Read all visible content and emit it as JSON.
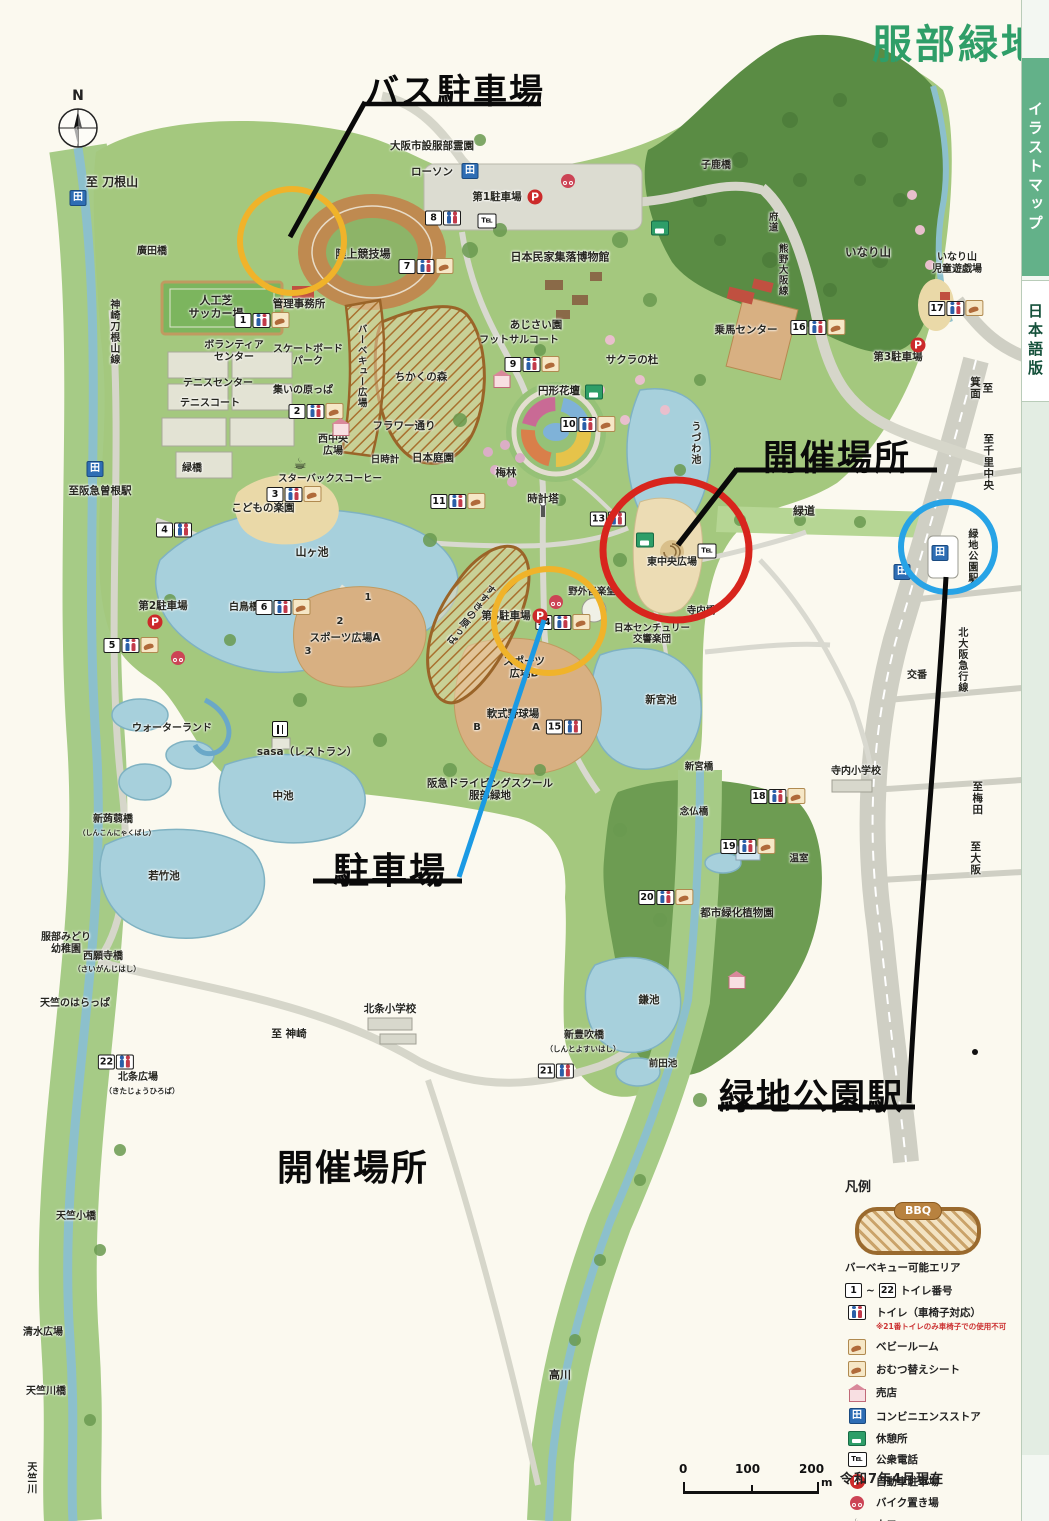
{
  "title": "服部緑地",
  "sidebar": {
    "top": "イラストマップ",
    "bottom": "日本語版"
  },
  "annotations": {
    "bus_parking": "バス駐車場",
    "event_location": "開催場所",
    "parking": "駐車場",
    "station": "緑地公園駅",
    "event_location_bottom": "開催場所"
  },
  "glyphs": {
    "north": "N",
    "parking": "P",
    "conbini": "田",
    "tel": "℡",
    "cafe": "☕"
  },
  "legend": {
    "heading": "凡例",
    "bbq_badge": "BBQ",
    "bbq_label": "バーベキュー可能エリア",
    "toilet_range": {
      "from": "1",
      "sep": "~",
      "to": "22",
      "label": "トイレ番号"
    },
    "items": [
      {
        "icon": "wc",
        "label": "トイレ（車椅子対応）",
        "note": "※21番トイレのみ車椅子での使用不可"
      },
      {
        "icon": "diaper",
        "label": "ベビールーム"
      },
      {
        "icon": "diaper",
        "label": "おむつ替えシート"
      },
      {
        "icon": "shop",
        "label": "売店"
      },
      {
        "icon": "conbini",
        "label": "コンビニエンスストア"
      },
      {
        "icon": "rest",
        "label": "休憩所"
      },
      {
        "icon": "tel",
        "label": "公衆電話"
      },
      {
        "icon": "parking",
        "label": "自動車駐車場"
      },
      {
        "icon": "bike",
        "label": "バイク置き場"
      },
      {
        "icon": "cafe",
        "label": "カフェ"
      },
      {
        "icon": "restaurant",
        "label": "レストラン"
      }
    ]
  },
  "date_note": "令和7年4月現在",
  "scale": {
    "t0": "0",
    "t1": "100",
    "t2": "200",
    "unit": "m"
  },
  "map_labels": [
    {
      "t": "至 刀根山",
      "x": 112,
      "y": 182,
      "s": 12
    },
    {
      "t": "廣田橋",
      "x": 152,
      "y": 252,
      "s": 10
    },
    {
      "t": "神崎刀根山線",
      "x": 113,
      "y": 332,
      "s": 10,
      "v": 1
    },
    {
      "t": "人工芝\nサッカー場",
      "x": 216,
      "y": 308,
      "s": 11
    },
    {
      "t": "管理事務所",
      "x": 299,
      "y": 304,
      "s": 10.5
    },
    {
      "t": "陸上競技場",
      "x": 363,
      "y": 255,
      "s": 11
    },
    {
      "t": "ボランティア\nセンター",
      "x": 234,
      "y": 352,
      "s": 10
    },
    {
      "t": "スケートボード\nパーク",
      "x": 308,
      "y": 356,
      "s": 10
    },
    {
      "t": "テニスセンター",
      "x": 218,
      "y": 384,
      "s": 10
    },
    {
      "t": "テニスコート",
      "x": 210,
      "y": 404,
      "s": 10
    },
    {
      "t": "集いの原っぱ",
      "x": 303,
      "y": 391,
      "s": 10
    },
    {
      "t": "バーベキュー広場",
      "x": 361,
      "y": 366,
      "s": 9.5,
      "v": 1
    },
    {
      "t": "ちかくの森",
      "x": 421,
      "y": 377,
      "s": 10.5
    },
    {
      "t": "フラワー通り",
      "x": 404,
      "y": 426,
      "s": 10.5
    },
    {
      "t": "西中央\n広場",
      "x": 333,
      "y": 446,
      "s": 10
    },
    {
      "t": "日時計",
      "x": 385,
      "y": 460,
      "s": 9.5
    },
    {
      "t": "日本庭園",
      "x": 433,
      "y": 458,
      "s": 10.5
    },
    {
      "t": "スターバックスコーヒー",
      "x": 330,
      "y": 479,
      "s": 9.5
    },
    {
      "t": "緑橋",
      "x": 192,
      "y": 469,
      "s": 10
    },
    {
      "t": "至阪急曽根駅",
      "x": 100,
      "y": 491,
      "s": 10.5
    },
    {
      "t": "こどもの楽園",
      "x": 263,
      "y": 508,
      "s": 10.5
    },
    {
      "t": "山ヶ池",
      "x": 312,
      "y": 553,
      "s": 11
    },
    {
      "t": "白鳥橋",
      "x": 244,
      "y": 608,
      "s": 10
    },
    {
      "t": "第2駐車場",
      "x": 163,
      "y": 606,
      "s": 10.5
    },
    {
      "t": "1",
      "x": 368,
      "y": 598,
      "s": 10
    },
    {
      "t": "2",
      "x": 340,
      "y": 622,
      "s": 10
    },
    {
      "t": "3",
      "x": 308,
      "y": 652,
      "s": 10
    },
    {
      "t": "スポーツ広場A",
      "x": 345,
      "y": 638,
      "s": 10.5
    },
    {
      "t": "スポーツ\n広場B",
      "x": 524,
      "y": 668,
      "s": 10.5
    },
    {
      "t": "軟式野球場",
      "x": 513,
      "y": 714,
      "s": 10.5
    },
    {
      "t": "B",
      "x": 477,
      "y": 728,
      "s": 10
    },
    {
      "t": "A",
      "x": 536,
      "y": 728,
      "s": 10
    },
    {
      "t": "第4駐車場",
      "x": 506,
      "y": 616,
      "s": 10.5
    },
    {
      "t": "野外音楽堂",
      "x": 592,
      "y": 592,
      "s": 9.5
    },
    {
      "t": "日本センチュリー\n交響楽団",
      "x": 652,
      "y": 634,
      "s": 9.5
    },
    {
      "t": "東中央広場",
      "x": 672,
      "y": 563,
      "s": 10
    },
    {
      "t": "うづわ池",
      "x": 694,
      "y": 443,
      "s": 10,
      "v": 1
    },
    {
      "t": "寺内橋",
      "x": 701,
      "y": 611,
      "s": 9.5
    },
    {
      "t": "緑道",
      "x": 804,
      "y": 512,
      "s": 11
    },
    {
      "t": "至千里中央",
      "x": 988,
      "y": 462,
      "s": 10.5,
      "v": 1
    },
    {
      "t": "緑地公園駅",
      "x": 971,
      "y": 556,
      "s": 10,
      "v": 1
    },
    {
      "t": "北大阪急行線",
      "x": 961,
      "y": 660,
      "s": 10,
      "v": 1
    },
    {
      "t": "交番",
      "x": 917,
      "y": 676,
      "s": 10
    },
    {
      "t": "寺内小学校",
      "x": 856,
      "y": 772,
      "s": 10
    },
    {
      "t": "至梅田",
      "x": 977,
      "y": 798,
      "s": 10.5,
      "v": 1
    },
    {
      "t": "至大阪",
      "x": 975,
      "y": 858,
      "s": 10.5,
      "v": 1
    },
    {
      "t": "新宮池",
      "x": 661,
      "y": 700,
      "s": 10.5
    },
    {
      "t": "新宮橋",
      "x": 699,
      "y": 767,
      "s": 9.5
    },
    {
      "t": "念仏橋",
      "x": 694,
      "y": 812,
      "s": 9.5
    },
    {
      "t": "温室",
      "x": 799,
      "y": 859,
      "s": 9.5
    },
    {
      "t": "都市緑化植物園",
      "x": 737,
      "y": 913,
      "s": 10.5
    },
    {
      "t": "鎌池",
      "x": 649,
      "y": 1000,
      "s": 10.5
    },
    {
      "t": "新豊吹橋",
      "x": 584,
      "y": 1036,
      "s": 10
    },
    {
      "t": "（しんとよすいはし）",
      "x": 583,
      "y": 1050,
      "s": 7.5
    },
    {
      "t": "前田池",
      "x": 663,
      "y": 1064,
      "s": 9.5
    },
    {
      "t": "高川",
      "x": 560,
      "y": 1376,
      "s": 11
    },
    {
      "t": "北条小学校",
      "x": 390,
      "y": 1009,
      "s": 10.5
    },
    {
      "t": "至 神崎",
      "x": 289,
      "y": 1034,
      "s": 10.5
    },
    {
      "t": "北条広場",
      "x": 138,
      "y": 1078,
      "s": 10
    },
    {
      "t": "（きたじょうひろば）",
      "x": 142,
      "y": 1092,
      "s": 7.5
    },
    {
      "t": "服部みどり\n幼稚園",
      "x": 66,
      "y": 944,
      "s": 10
    },
    {
      "t": "西願寺橋",
      "x": 103,
      "y": 957,
      "s": 10
    },
    {
      "t": "（さいがんじはし）",
      "x": 107,
      "y": 970,
      "s": 7.5
    },
    {
      "t": "天竺のはらっぱ",
      "x": 75,
      "y": 1004,
      "s": 10
    },
    {
      "t": "天竺小橋",
      "x": 76,
      "y": 1217,
      "s": 10
    },
    {
      "t": "清水広場",
      "x": 43,
      "y": 1333,
      "s": 10
    },
    {
      "t": "天竺川橋",
      "x": 46,
      "y": 1392,
      "s": 10
    },
    {
      "t": "天竺川",
      "x": 30,
      "y": 1478,
      "s": 10,
      "v": 1
    },
    {
      "t": "中池",
      "x": 283,
      "y": 796,
      "s": 10.5
    },
    {
      "t": "若竹池",
      "x": 164,
      "y": 876,
      "s": 10.5
    },
    {
      "t": "新蒟蒻橋",
      "x": 113,
      "y": 820,
      "s": 10
    },
    {
      "t": "（しんこんにゃくばし）",
      "x": 117,
      "y": 833,
      "s": 7
    },
    {
      "t": "ウォーターランド",
      "x": 172,
      "y": 729,
      "s": 10
    },
    {
      "t": "sasa（レストラン）",
      "x": 307,
      "y": 752,
      "s": 10.5
    },
    {
      "t": "阪急ドライビングスクール\n服部緑地",
      "x": 490,
      "y": 790,
      "s": 10.5
    },
    {
      "t": "ローソン",
      "x": 432,
      "y": 172,
      "s": 10.5
    },
    {
      "t": "第1駐車場",
      "x": 497,
      "y": 197,
      "s": 10.5
    },
    {
      "t": "大阪市設服部霊園",
      "x": 432,
      "y": 146,
      "s": 10.5
    },
    {
      "t": "日本民家集落博物館",
      "x": 560,
      "y": 258,
      "s": 11
    },
    {
      "t": "あじさい園",
      "x": 536,
      "y": 325,
      "s": 10.5
    },
    {
      "t": "フットサルコート",
      "x": 519,
      "y": 341,
      "s": 10
    },
    {
      "t": "サクラの杜",
      "x": 632,
      "y": 360,
      "s": 10.5
    },
    {
      "t": "円形花壇",
      "x": 559,
      "y": 391,
      "s": 10.5
    },
    {
      "t": "梅林",
      "x": 506,
      "y": 473,
      "s": 10.5
    },
    {
      "t": "時計塔",
      "x": 543,
      "y": 499,
      "s": 10.5
    },
    {
      "t": "子鹿橋",
      "x": 716,
      "y": 166,
      "s": 10
    },
    {
      "t": "府道",
      "x": 772,
      "y": 222,
      "s": 9.5,
      "v": 1
    },
    {
      "t": "熊野大阪線",
      "x": 782,
      "y": 270,
      "s": 9.5,
      "v": 1
    },
    {
      "t": "いなり山",
      "x": 868,
      "y": 253,
      "s": 11.5
    },
    {
      "t": "乗馬センター",
      "x": 746,
      "y": 330,
      "s": 10.5
    },
    {
      "t": "第3駐車場",
      "x": 898,
      "y": 357,
      "s": 10.5
    },
    {
      "t": "いなり山\n児童遊戯場",
      "x": 957,
      "y": 264,
      "s": 10
    },
    {
      "t": "至\n箕面",
      "x": 981,
      "y": 388,
      "s": 10.5,
      "v": 1
    },
    {
      "t": "すすきの原っぱ",
      "x": 470,
      "y": 614,
      "s": 9.5,
      "v": 1,
      "r": 38
    }
  ],
  "markers": {
    "toilets": [
      {
        "n": "1",
        "x": 262,
        "y": 320,
        "d": 1
      },
      {
        "n": "2",
        "x": 316,
        "y": 411,
        "d": 1
      },
      {
        "n": "3",
        "x": 294,
        "y": 494,
        "d": 1
      },
      {
        "n": "4",
        "x": 174,
        "y": 530
      },
      {
        "n": "5",
        "x": 131,
        "y": 645,
        "d": 1
      },
      {
        "n": "6",
        "x": 283,
        "y": 607,
        "d": 1
      },
      {
        "n": "7",
        "x": 426,
        "y": 266,
        "d": 1
      },
      {
        "n": "8",
        "x": 443,
        "y": 218
      },
      {
        "n": "9",
        "x": 532,
        "y": 364,
        "d": 1
      },
      {
        "n": "10",
        "x": 588,
        "y": 424,
        "d": 1
      },
      {
        "n": "11",
        "x": 458,
        "y": 501,
        "d": 1
      },
      {
        "n": "13",
        "x": 608,
        "y": 519
      },
      {
        "n": "14",
        "x": 563,
        "y": 622,
        "d": 1
      },
      {
        "n": "15",
        "x": 564,
        "y": 727
      },
      {
        "n": "16",
        "x": 818,
        "y": 327,
        "d": 1
      },
      {
        "n": "17",
        "x": 956,
        "y": 308,
        "d": 1
      },
      {
        "n": "18",
        "x": 778,
        "y": 796,
        "d": 1
      },
      {
        "n": "19",
        "x": 748,
        "y": 846,
        "d": 1
      },
      {
        "n": "20",
        "x": 666,
        "y": 897,
        "d": 1
      },
      {
        "n": "21",
        "x": 556,
        "y": 1071
      },
      {
        "n": "22",
        "x": 116,
        "y": 1062
      }
    ],
    "parking": [
      {
        "x": 535,
        "y": 197
      },
      {
        "x": 155,
        "y": 622
      },
      {
        "x": 918,
        "y": 345
      },
      {
        "x": 540,
        "y": 616
      }
    ],
    "bike": [
      {
        "x": 568,
        "y": 181
      },
      {
        "x": 178,
        "y": 658
      },
      {
        "x": 556,
        "y": 602
      }
    ],
    "conbini": [
      {
        "x": 78,
        "y": 198
      },
      {
        "x": 470,
        "y": 171
      },
      {
        "x": 95,
        "y": 469
      },
      {
        "x": 940,
        "y": 553
      },
      {
        "x": 902,
        "y": 572
      }
    ],
    "rest": [
      {
        "x": 660,
        "y": 228
      },
      {
        "x": 594,
        "y": 392
      },
      {
        "x": 645,
        "y": 540
      }
    ],
    "tel": [
      {
        "x": 487,
        "y": 221
      },
      {
        "x": 707,
        "y": 551
      }
    ],
    "cafe": [
      {
        "x": 300,
        "y": 464
      }
    ],
    "restaurant": [
      {
        "x": 280,
        "y": 729
      }
    ],
    "shop": [
      {
        "x": 341,
        "y": 427
      },
      {
        "x": 502,
        "y": 379
      },
      {
        "x": 737,
        "y": 980
      }
    ]
  }
}
